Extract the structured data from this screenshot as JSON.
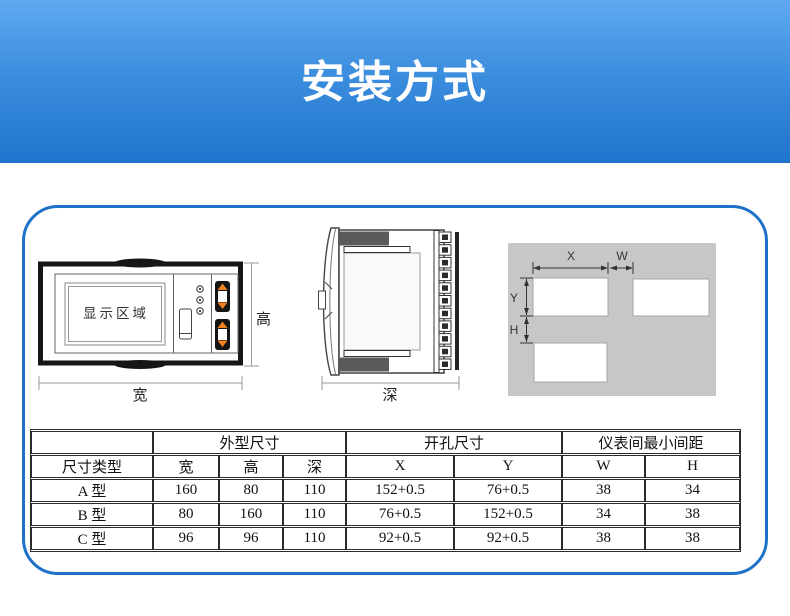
{
  "header": {
    "title": "安装方式"
  },
  "colors": {
    "banner_top": "#60a9f1",
    "banner_bottom": "#1e74cc",
    "panel_border_blue": "#1e71c8",
    "button_orange": "#f08121",
    "clamp_gray": "#5c5a58",
    "cutout_panel_gray": "#c9c7c5",
    "bezel_black": "#161616"
  },
  "diagrams": {
    "front_view": {
      "display_area_label": "显示区域",
      "width_label": "宽",
      "height_label": "高"
    },
    "side_view": {
      "depth_label": "深"
    },
    "cutout": {
      "x_label": "X",
      "w_label": "W",
      "y_label": "Y",
      "h_label": "H"
    }
  },
  "table": {
    "group_headers": [
      "外型尺寸",
      "开孔尺寸",
      "仪表间最小间距"
    ],
    "columns": [
      "尺寸类型",
      "宽",
      "高",
      "深",
      "X",
      "Y",
      "W",
      "H"
    ],
    "rows": [
      [
        "A 型",
        "160",
        "80",
        "110",
        "152+0.5",
        "76+0.5",
        "38",
        "34"
      ],
      [
        "B 型",
        "80",
        "160",
        "110",
        "76+0.5",
        "152+0.5",
        "34",
        "38"
      ],
      [
        "C 型",
        "96",
        "96",
        "110",
        "92+0.5",
        "92+0.5",
        "38",
        "38"
      ]
    ]
  }
}
